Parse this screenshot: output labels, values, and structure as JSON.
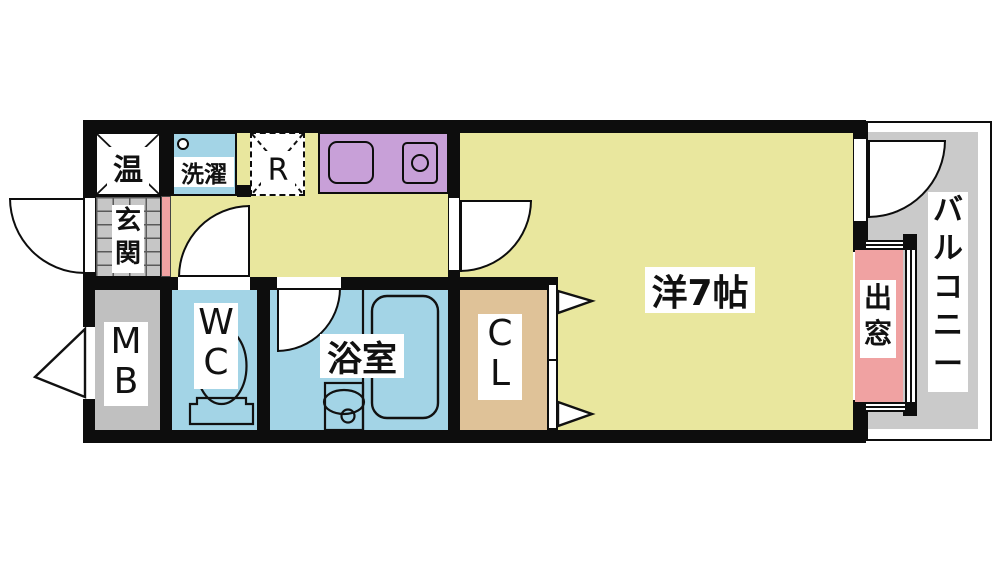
{
  "diagram_type": "japanese-apartment-floor-plan",
  "unit_layout": "1K",
  "rooms": {
    "western_room": {
      "label": "洋7帖"
    },
    "entrance": {
      "label": "玄関"
    },
    "water_heater": {
      "label": "温"
    },
    "laundry": {
      "label": "洗濯"
    },
    "refrigerator": {
      "label": "R"
    },
    "wc": {
      "label": "WC"
    },
    "bathroom": {
      "label": "浴室"
    },
    "meter_box": {
      "label": "MB"
    },
    "closet": {
      "label": "CL"
    },
    "bay_window": {
      "label": "出窓"
    },
    "balcony": {
      "label": "バルコニー"
    }
  },
  "colors": {
    "wall": "#0d0d0d",
    "floor": "#e9e79e",
    "water": "#a3d4e6",
    "counter": "#c8a0d8",
    "tile": "#c6c6c6",
    "meter": "#c0c0c0",
    "balcony": "#cacaca",
    "pink": "#f0a2a2",
    "closet": "#dfc298"
  }
}
